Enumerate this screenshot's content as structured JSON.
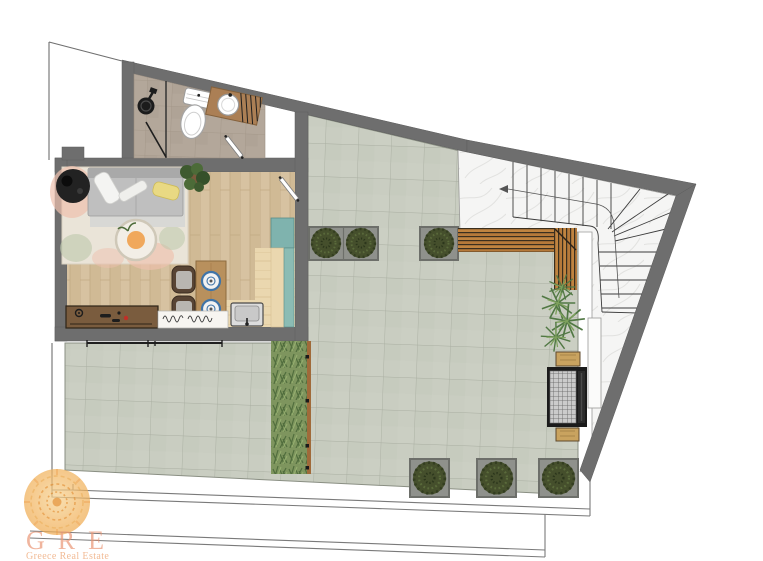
{
  "page": {
    "width": 763,
    "height": 561,
    "background": "#ffffff",
    "kind": "architectural floor plan rendering"
  },
  "logo": {
    "brand": "GRE",
    "subtitle": "Greece Real Estate",
    "text_color": "#ea9574",
    "sun_color": "#f0a94f"
  },
  "palette": {
    "wall_gray": "#6e6e6e",
    "terrace_tile": "#c9cdc1",
    "bathroom_tile": "#b3a79a",
    "wood_floor": "#d7c2a1",
    "kitchen_wood": "#ead7af",
    "marble": "#f5f5f4",
    "teal_cabinet": "#7fb3ae",
    "bench_wood": "#c08440",
    "bush_green": "#47522e",
    "palm_green": "#57783f",
    "rug_beige": "#eae4d8",
    "rug_blush": "#eec0ae",
    "rug_sage": "#bcc8ac",
    "accent_orange": "#f0a85c",
    "plate_blue": "#3f74a8",
    "boundary_line": "#6f6f6f"
  },
  "plan": {
    "rooms": [
      "bathroom",
      "living-room",
      "kitchen",
      "terrace",
      "staircase-landing"
    ],
    "elements": [
      "shower",
      "toilet",
      "vanity-sink",
      "bathroom-door",
      "sofa",
      "pillows",
      "side-table",
      "coffee-table",
      "area-rug",
      "potted-plant",
      "dining-table",
      "dining-chairs",
      "plates",
      "kitchen-sink",
      "teal-cabinet",
      "desk",
      "doormat",
      "sliding-door",
      "entrance-door",
      "wooden-bench",
      "palm-plants",
      "grass-planter",
      "bushes-planters",
      "bbq-grill",
      "marble-stairs",
      "property-steps"
    ]
  }
}
